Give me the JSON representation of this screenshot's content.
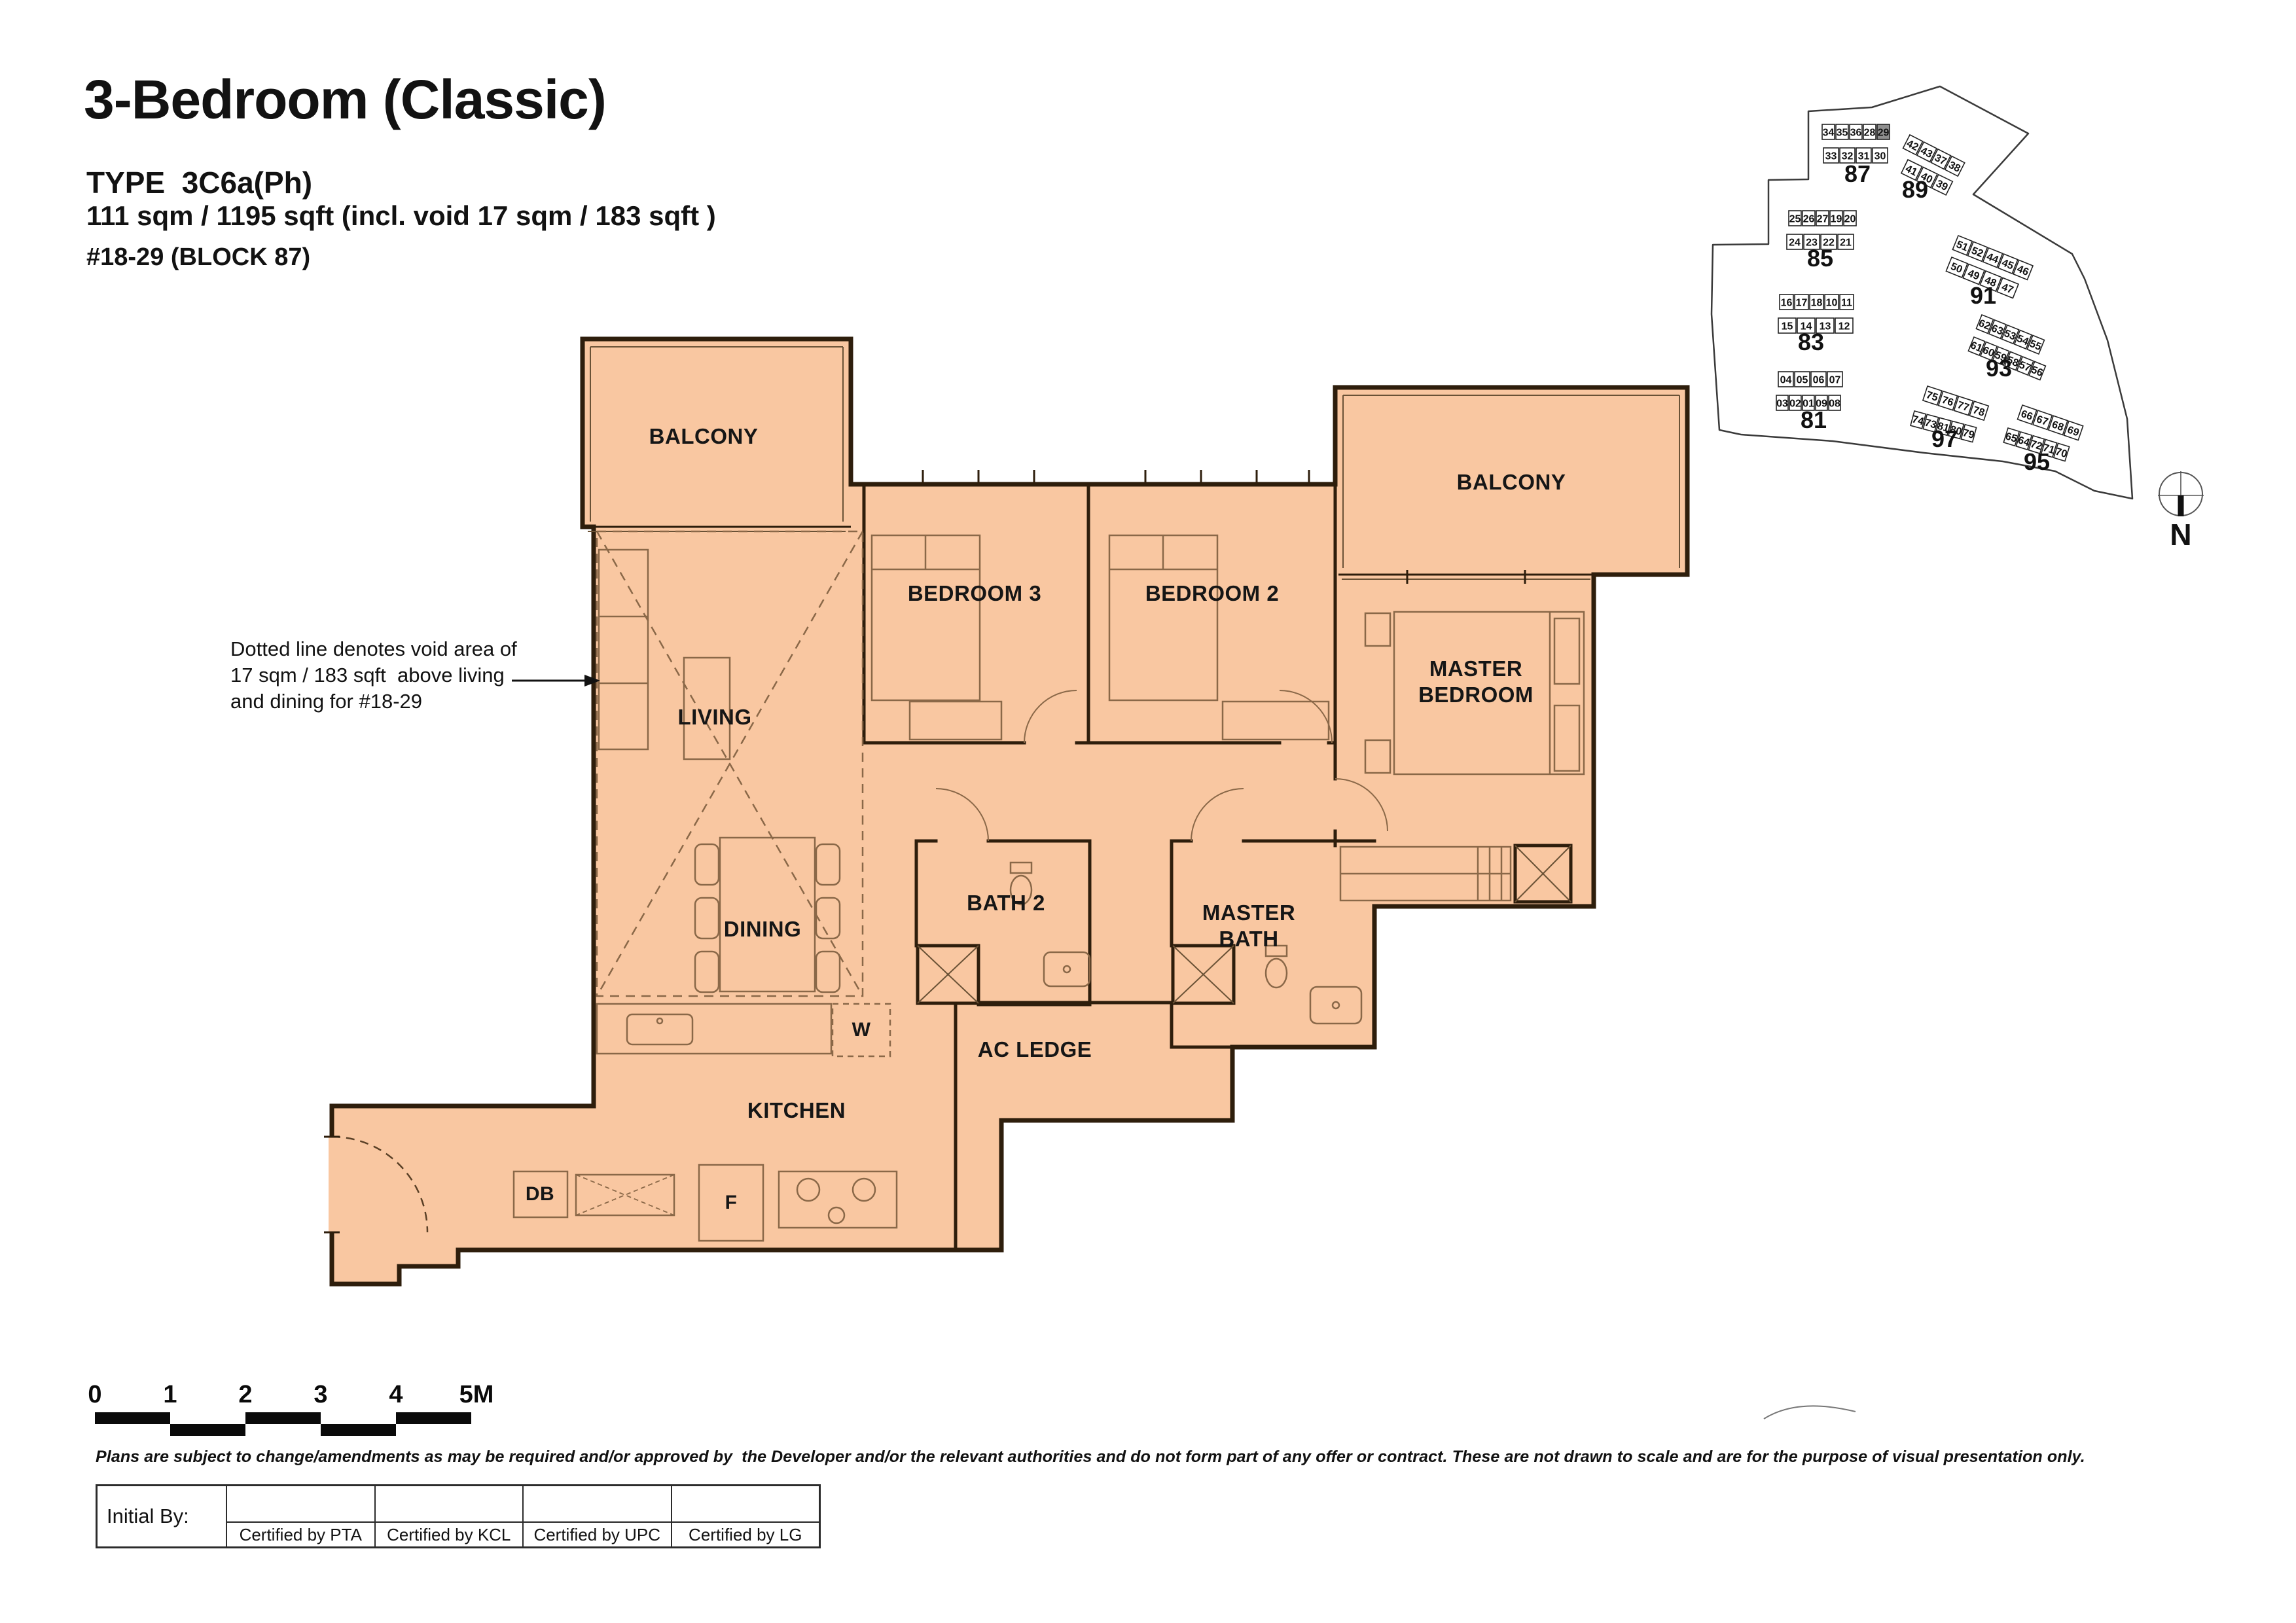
{
  "header": {
    "title": "3-Bedroom (Classic)",
    "type_label": "TYPE  3C6a(Ph)",
    "area_label": "111 sqm / 1195 sqft (incl. void 17 sqm / 183 sqft )",
    "unit_range": "#18-29 (BLOCK 87)"
  },
  "annotation": {
    "line1": "Dotted line denotes void area of",
    "line2": "17 sqm / 183 sqft  above living",
    "line3": "and dining for #18-29"
  },
  "plan": {
    "fill_color": "#F9C7A1",
    "wall_color": "#2E1E0C",
    "rooms": [
      {
        "id": "balcony-left",
        "label": "BALCONY"
      },
      {
        "id": "bedroom-3",
        "label": "BEDROOM 3"
      },
      {
        "id": "bedroom-2",
        "label": "BEDROOM 2"
      },
      {
        "id": "balcony-right",
        "label": "BALCONY"
      },
      {
        "id": "master-bedroom",
        "label": "MASTER\nBEDROOM"
      },
      {
        "id": "living",
        "label": "LIVING"
      },
      {
        "id": "dining",
        "label": "DINING"
      },
      {
        "id": "bath-2",
        "label": "BATH 2"
      },
      {
        "id": "master-bath",
        "label": "MASTER\nBATH"
      },
      {
        "id": "ac-ledge",
        "label": "AC LEDGE"
      },
      {
        "id": "kitchen",
        "label": "KITCHEN"
      },
      {
        "id": "washer",
        "label": "W"
      },
      {
        "id": "fridge",
        "label": "F"
      },
      {
        "id": "db",
        "label": "DB"
      }
    ]
  },
  "site_map": {
    "highlight_block": "87",
    "highlight_unit": "29",
    "highlight_color": "#8F8F8F",
    "compass_label": "N",
    "blocks": [
      {
        "name": "87",
        "rows": [
          [
            "34",
            "35",
            "36",
            "28",
            "29"
          ],
          [
            "33",
            "32",
            "31",
            "30"
          ]
        ]
      },
      {
        "name": "89",
        "rows": [
          [
            "42",
            "43",
            "37",
            "38"
          ],
          [
            "41",
            "40",
            "39"
          ]
        ]
      },
      {
        "name": "85",
        "rows": [
          [
            "25",
            "26",
            "27",
            "19",
            "20"
          ],
          [
            "24",
            "23",
            "22",
            "21"
          ]
        ]
      },
      {
        "name": "83",
        "rows": [
          [
            "16",
            "17",
            "18",
            "10",
            "11"
          ],
          [
            "15",
            "14",
            "13",
            "12"
          ]
        ]
      },
      {
        "name": "81",
        "rows": [
          [
            "04",
            "05",
            "06",
            "07"
          ],
          [
            "03",
            "02",
            "01",
            "09",
            "08"
          ]
        ]
      },
      {
        "name": "91",
        "rows": [
          [
            "51",
            "52",
            "44",
            "45",
            "46"
          ],
          [
            "50",
            "49",
            "48",
            "47"
          ]
        ]
      },
      {
        "name": "93",
        "rows": [
          [
            "62",
            "63",
            "53",
            "54",
            "55"
          ],
          [
            "61",
            "60",
            "59",
            "58",
            "57",
            "56"
          ]
        ]
      },
      {
        "name": "97",
        "rows": [
          [
            "75",
            "76",
            "77",
            "78"
          ],
          [
            "74",
            "73",
            "81",
            "80",
            "79"
          ]
        ]
      },
      {
        "name": "95",
        "rows": [
          [
            "66",
            "67",
            "68",
            "69"
          ],
          [
            "65",
            "64",
            "72",
            "71",
            "70"
          ]
        ]
      }
    ]
  },
  "scale_bar": {
    "labels": [
      "0",
      "1",
      "2",
      "3",
      "4",
      "5M"
    ]
  },
  "disclaimer": "Plans are subject to change/amendments as may be required and/or approved by  the Developer and/or the relevant authorities and do not form part of any offer or contract. These are not drawn to scale and are for the purpose of visual presentation only.",
  "table": {
    "initial_by": "Initial By:",
    "columns": [
      "Certified by PTA",
      "Certified by KCL",
      "Certified by UPC",
      "Certified by LG"
    ]
  }
}
